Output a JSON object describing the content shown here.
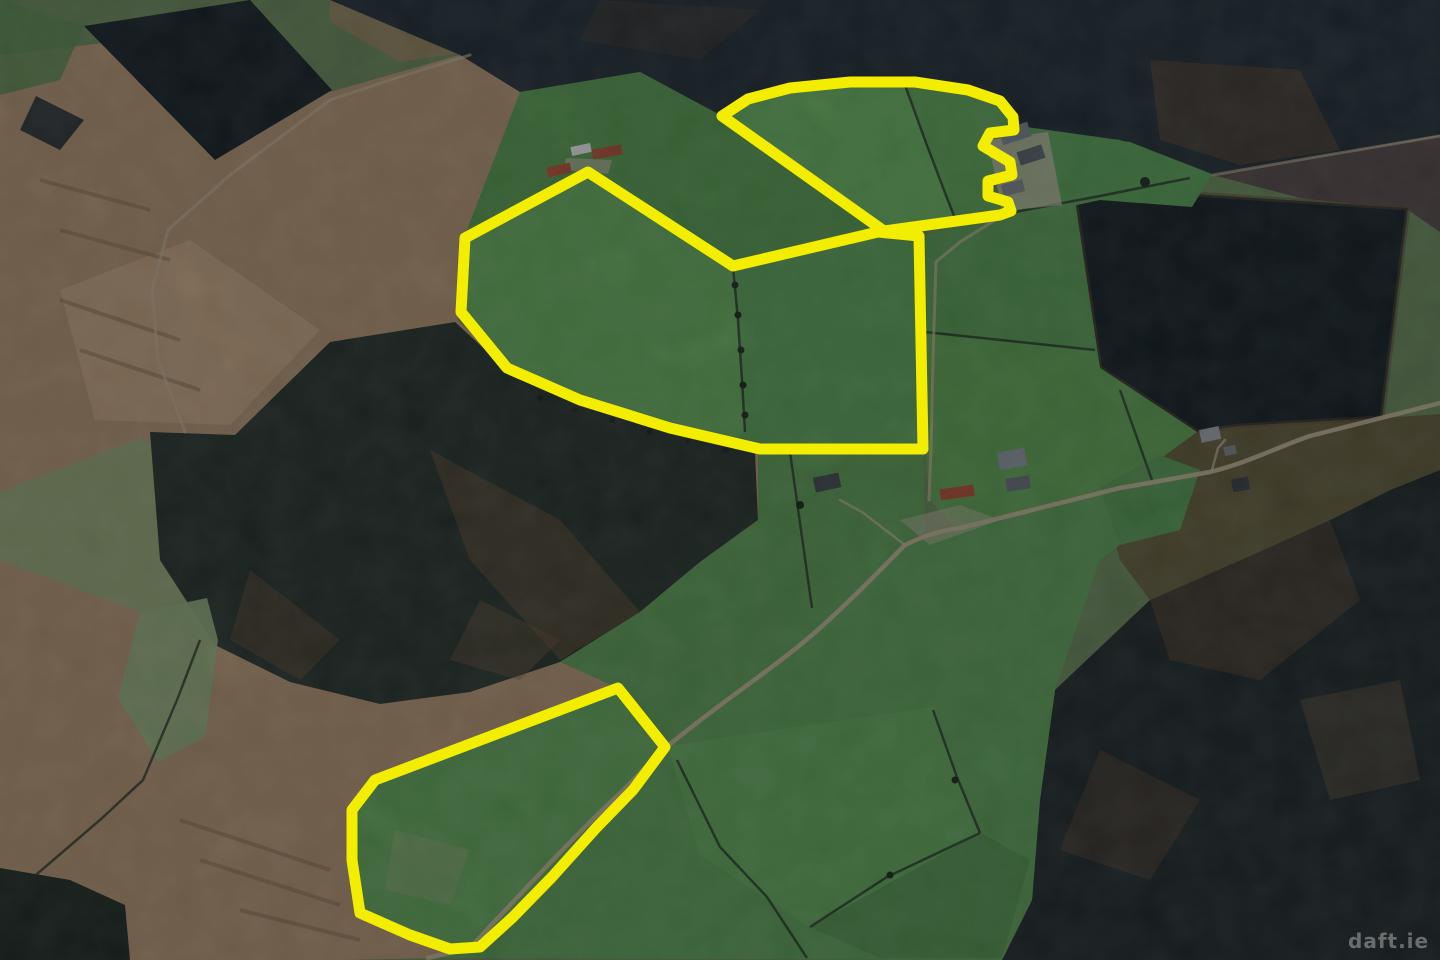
{
  "image": {
    "kind": "aerial-satellite-photo-with-land-outlines",
    "watermark": "daft.ie"
  },
  "annotation": {
    "highlight_color": "#f3ed00",
    "outline_width": 11,
    "parcels": [
      {
        "name": "north-parcel",
        "points": "722,116 748,99 790,88 850,82 915,82 968,90 1000,101 1013,117 1014,130 990,133 983,146 1010,162 1012,175 988,181 988,196 1008,202 1011,211 1000,215 884,231"
      },
      {
        "name": "central-parcel",
        "points": "588,172 465,238 461,312 507,368 580,400 670,428 760,449 923,449 919,236 878,232 733,266"
      },
      {
        "name": "south-parcel",
        "points": "618,688 665,747 633,790 597,827 552,877 513,917 480,947 450,949 410,935 360,913 352,860 352,810 375,780"
      }
    ]
  },
  "watermark_style": {
    "color": "#ffffff",
    "opacity": 0.34
  }
}
